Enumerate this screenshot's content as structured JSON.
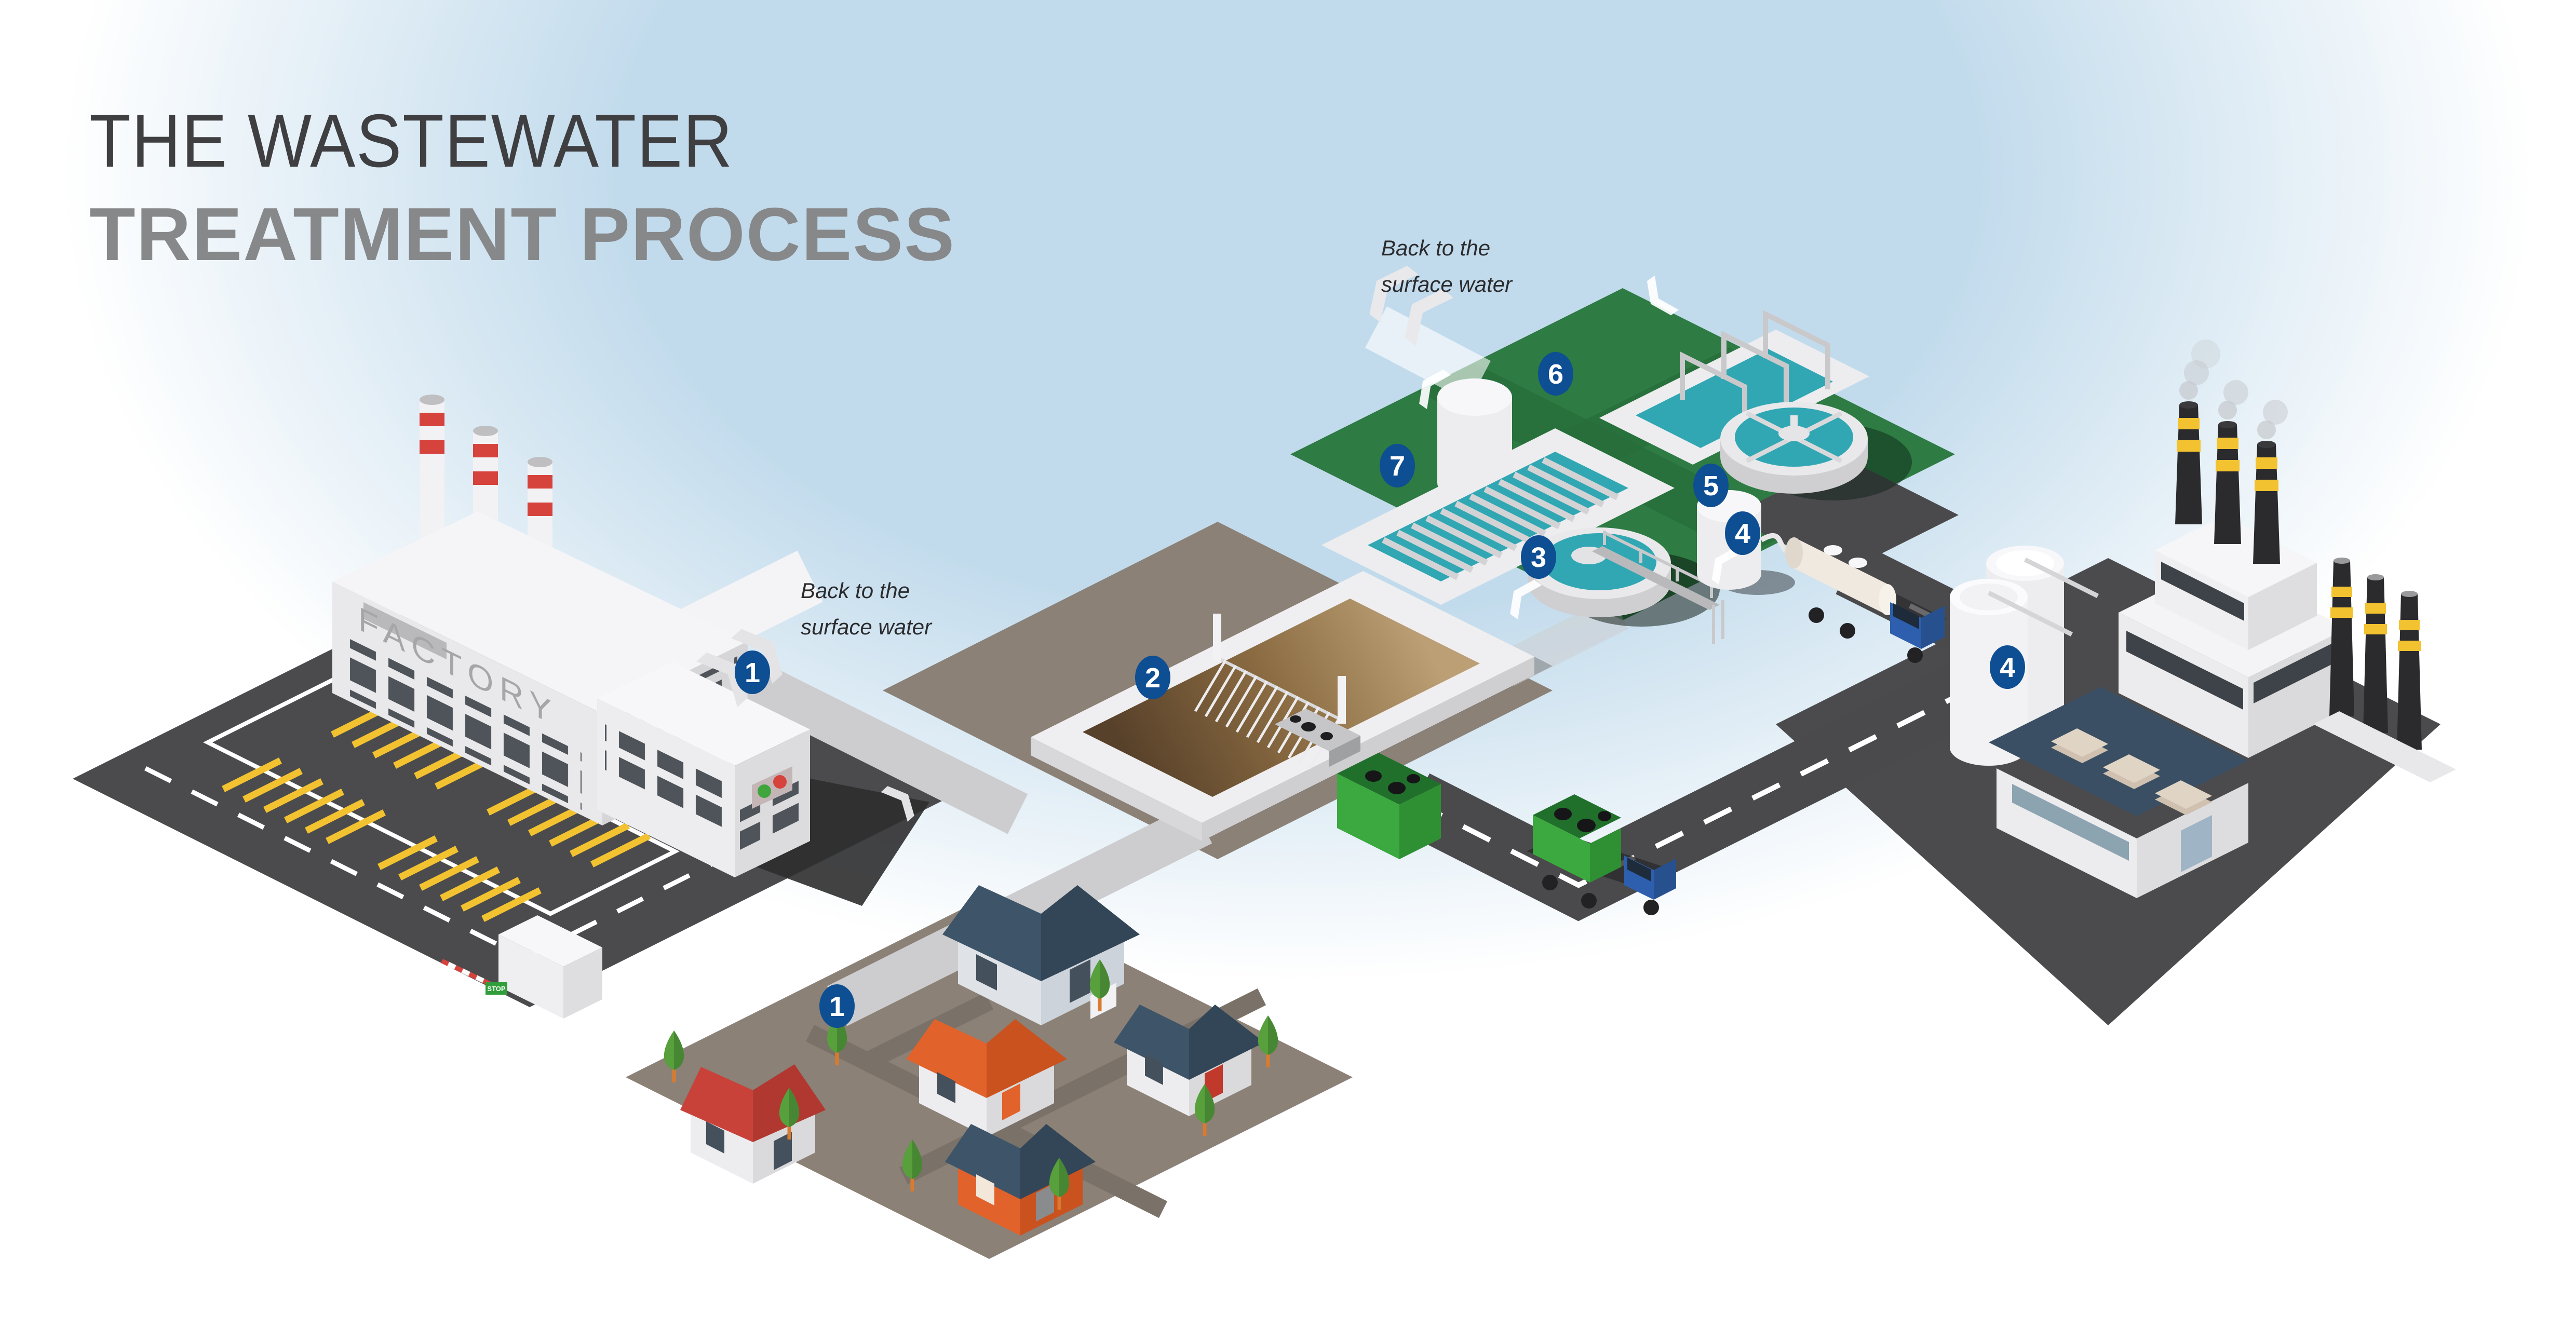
{
  "title": {
    "line1": "THE WASTEWATER",
    "line2": "TREATMENT PROCESS"
  },
  "annotations": {
    "factory_outflow": {
      "line1": "Back to the",
      "line2": "surface water"
    },
    "plant_outflow": {
      "line1": "Back to the",
      "line2": "surface water"
    }
  },
  "factory": {
    "sign": "FACTORY",
    "stop_sign": "STOP"
  },
  "badges": [
    {
      "id": "industrial-wastewater",
      "label": "1"
    },
    {
      "id": "domestic-wastewater",
      "label": "1"
    },
    {
      "id": "screening-basin",
      "label": "2"
    },
    {
      "id": "primary-clarifier",
      "label": "3"
    },
    {
      "id": "sludge-storage-tank",
      "label": "4"
    },
    {
      "id": "sludge-processing-plant",
      "label": "4"
    },
    {
      "id": "secondary-clarifier",
      "label": "5"
    },
    {
      "id": "aeration-tank",
      "label": "6"
    },
    {
      "id": "filter-beds",
      "label": "7"
    }
  ],
  "colors": {
    "background_blue": "#C2DBEC",
    "title_dark": "#3F3F41",
    "title_gray": "#87888A",
    "badge_blue": "#0E4E92",
    "treatment_green": "#2E7B44",
    "water_teal": "#31A7B3",
    "basin_brown": "#6B4F2E",
    "ground_dark": "#4B4B4D",
    "ground_taupe": "#8B8177",
    "road_asphalt": "#4A4A4C",
    "pipe_gray": "#CDCDCF",
    "accent_red": "#D6423C",
    "accent_yellow": "#F2C230",
    "truck_blue": "#2E5FAE",
    "skip_green": "#3BA93F",
    "roof_red": "#C8423A",
    "roof_orange": "#E2622B",
    "roof_slate": "#3E5468",
    "wall_white": "#ECECEE"
  }
}
